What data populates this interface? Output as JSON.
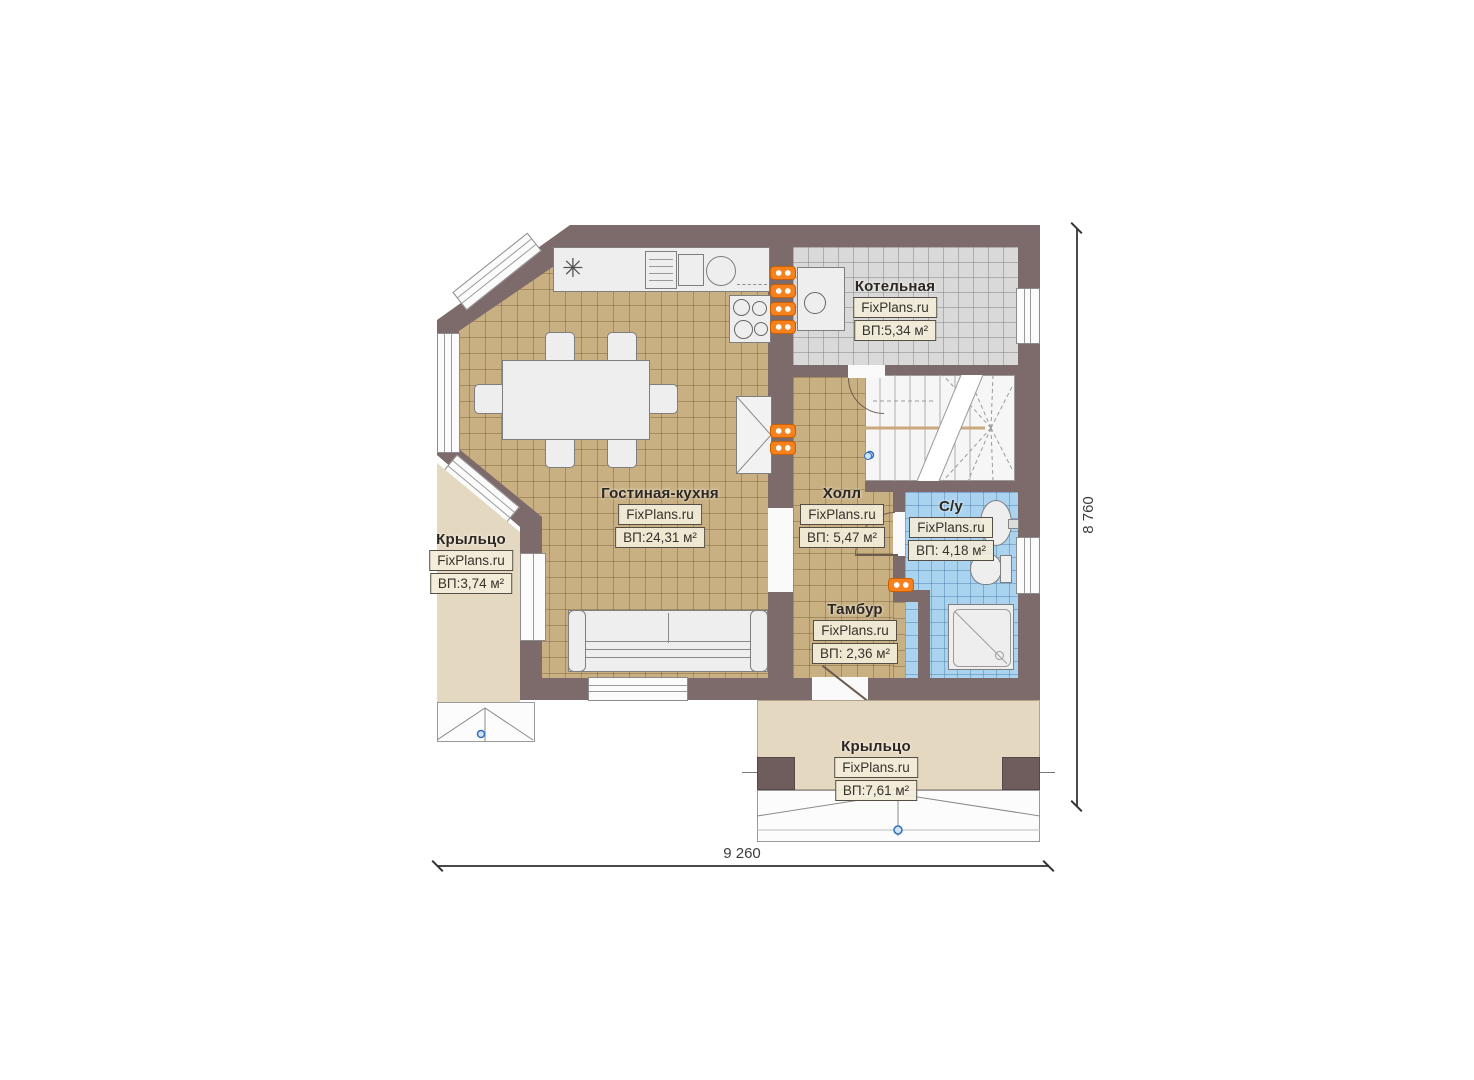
{
  "plan": {
    "title_watermark": "FixPlans.ru",
    "rooms": [
      {
        "id": "kotelnaya",
        "name": "Котельная",
        "watermark": "FixPlans.ru",
        "area": "ВП:5,34 м²"
      },
      {
        "id": "gostinaya-kuhnya",
        "name": "Гостиная-кухня",
        "watermark": "FixPlans.ru",
        "area": "ВП:24,31 м²"
      },
      {
        "id": "holl",
        "name": "Холл",
        "watermark": "FixPlans.ru",
        "area": "ВП: 5,47 м²"
      },
      {
        "id": "sanuzel",
        "name": "С/у",
        "watermark": "FixPlans.ru",
        "area": "ВП: 4,18 м²"
      },
      {
        "id": "tambur",
        "name": "Тамбур",
        "watermark": "FixPlans.ru",
        "area": "ВП: 2,36 м²"
      },
      {
        "id": "kryltso-left",
        "name": "Крыльцо",
        "watermark": "FixPlans.ru",
        "area": "ВП:3,74 м²"
      },
      {
        "id": "kryltso-bottom",
        "name": "Крыльцо",
        "watermark": "FixPlans.ru",
        "area": "ВП:7,61 м²"
      }
    ],
    "dimensions": {
      "width": "9 260",
      "height": "8 760"
    },
    "colors": {
      "wall": "#7d6b6b",
      "floor_tan": "#c8b083",
      "floor_gray": "#d9d9d9",
      "floor_blue": "#a9d3ee",
      "porch_beige": "#e5d8c1",
      "radiator_orange": "#f5821f",
      "label_box_bg": "#f2ecd9",
      "marker_blue": "#2f6fb8"
    }
  }
}
